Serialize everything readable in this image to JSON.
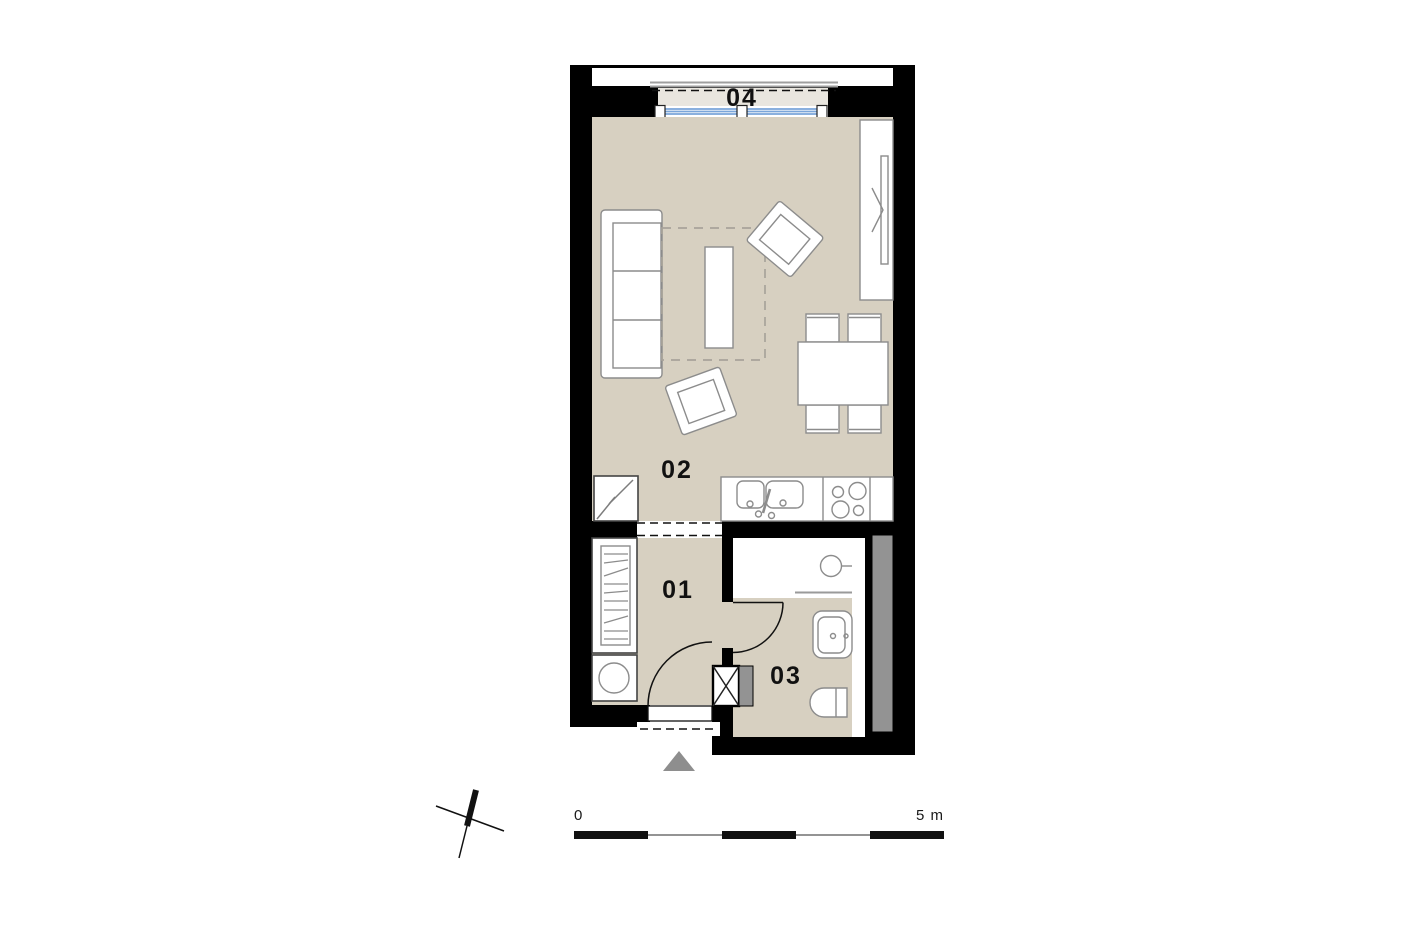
{
  "plan": {
    "rooms": {
      "r01": {
        "label": "01"
      },
      "r02": {
        "label": "02"
      },
      "r03": {
        "label": "03"
      },
      "r04": {
        "label": "04"
      }
    },
    "scale_bar": {
      "zero_label": "0",
      "max_label": "5 m"
    },
    "symbols": {
      "north_indicator": "north-arrow",
      "entrance_marker": "entrance-arrow-triangle",
      "shaft_marker": "crossed-shaft-icon"
    },
    "colors": {
      "wall": "#000000",
      "floor": "#d7d0c1",
      "balcony_floor": "#e9e6df",
      "furniture_stroke": "#8c8c8c",
      "window_glass": "#7aa5d9",
      "shaft_gray": "#939393",
      "entrance_arrow": "#8e8e8e"
    }
  }
}
